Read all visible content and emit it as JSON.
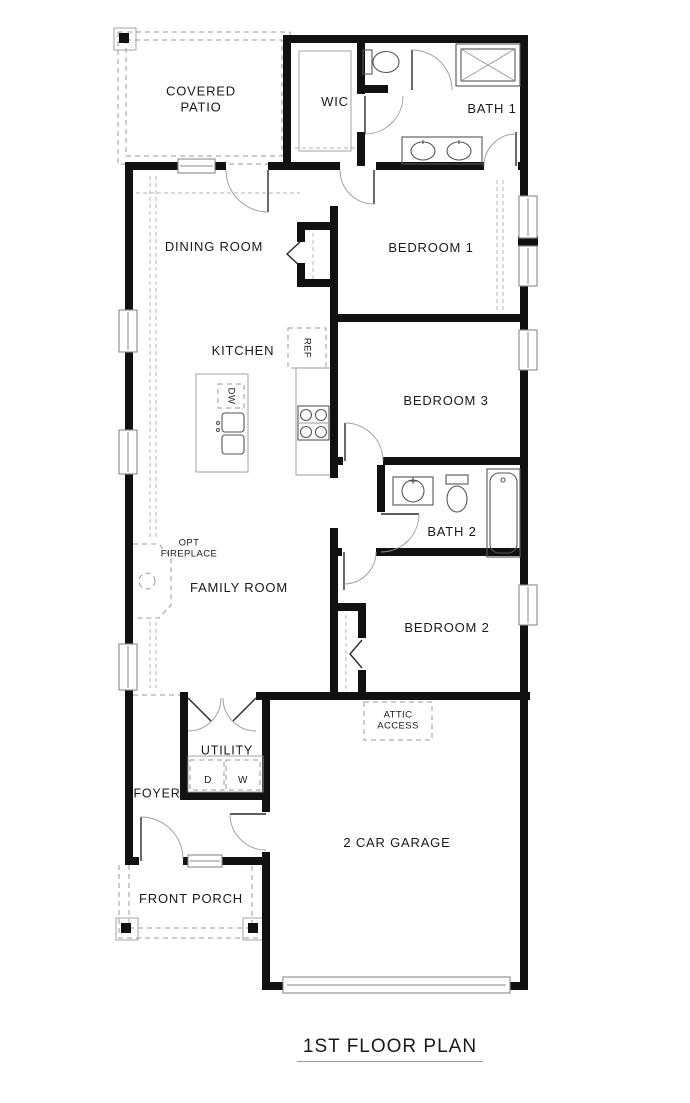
{
  "title": "1ST FLOOR PLAN",
  "rooms": {
    "covered_patio": "COVERED\nPATIO",
    "wic": "WIC",
    "bath_1": "BATH 1",
    "dining_room": "DINING ROOM",
    "bedroom_1": "BEDROOM 1",
    "kitchen": "KITCHEN",
    "bedroom_3": "BEDROOM 3",
    "bath_2": "BATH 2",
    "opt_fireplace": "OPT\nFIREPLACE",
    "family_room": "FAMILY ROOM",
    "bedroom_2": "BEDROOM 2",
    "utility": "UTILITY",
    "foyer": "FOYER",
    "attic_access": "ATTIC\nACCESS",
    "garage": "2 CAR GARAGE",
    "front_porch": "FRONT PORCH"
  },
  "appliances": {
    "refrigerator": "REF",
    "dishwasher": "DW",
    "dryer": "D",
    "washer": "W"
  },
  "colors": {
    "wall": "#111111",
    "dashed": "#9a9a9a",
    "fixture": "#555555",
    "text": "#1a1a1a"
  }
}
